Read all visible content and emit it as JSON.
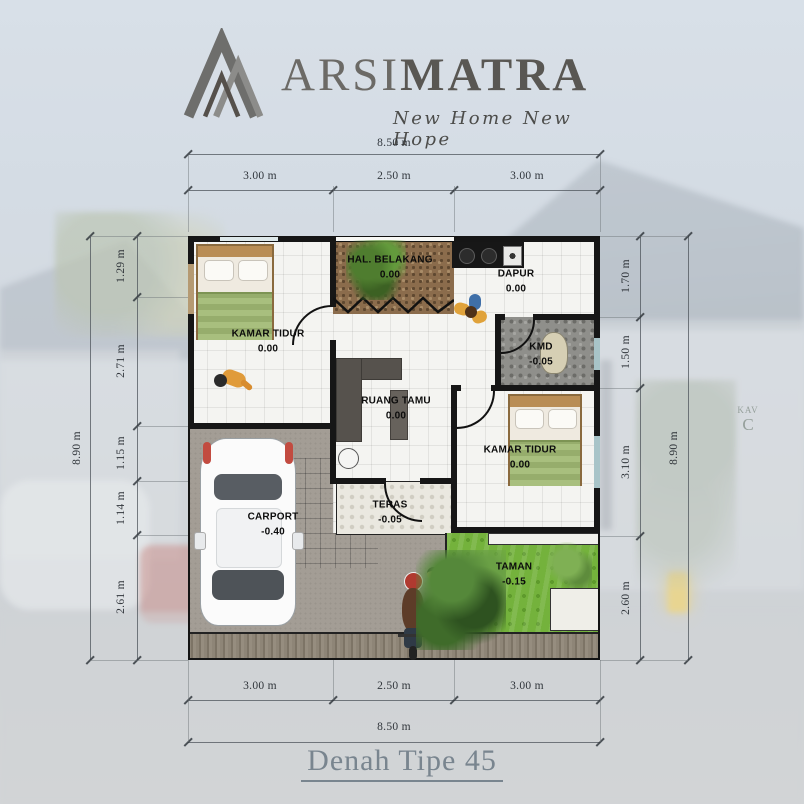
{
  "logo": {
    "brand_light": "ARSI",
    "brand_bold": "MATRA",
    "tagline": "New Home New Hope"
  },
  "title": "Denah Tipe 45",
  "background_sign": {
    "line1": "KAV",
    "line2": "C"
  },
  "dimensions": {
    "top": {
      "overall": "8.50 m",
      "seg1": "3.00 m",
      "seg2": "2.50 m",
      "seg3": "3.00 m"
    },
    "bottom": {
      "overall": "8.50 m",
      "seg1": "3.00 m",
      "seg2": "2.50 m",
      "seg3": "3.00 m"
    },
    "left": {
      "overall": "8.90 m",
      "seg1": "1.29 m",
      "seg2": "2.71 m",
      "seg3": "1.15 m",
      "seg4": "1.14 m",
      "seg5": "2.61 m"
    },
    "right": {
      "overall": "8.90 m",
      "seg1": "1.70 m",
      "seg2": "1.50 m",
      "seg3": "3.10 m",
      "seg4": "2.60 m"
    }
  },
  "rooms": {
    "bedroom1": {
      "name": "KAMAR TIDUR",
      "level": "0.00"
    },
    "hal_belakang": {
      "name": "HAL. BELAKANG",
      "level": "0.00"
    },
    "dapur": {
      "name": "DAPUR",
      "level": "0.00"
    },
    "kmd": {
      "name": "KMD",
      "level": "-0.05"
    },
    "ruang_tamu": {
      "name": "RUANG TAMU",
      "level": "0.00"
    },
    "bedroom2": {
      "name": "KAMAR TIDUR",
      "level": "0.00"
    },
    "teras": {
      "name": "TERAS",
      "level": "-0.05"
    },
    "carport": {
      "name": "CARPORT",
      "level": "-0.40"
    },
    "taman": {
      "name": "TAMAN",
      "level": "-0.15"
    }
  },
  "colors": {
    "wall": "#161616",
    "grass": "#74b23c",
    "sky": "#cdd6e0",
    "title_text": "#79858f",
    "hal_floor": "#8b6c4c"
  }
}
